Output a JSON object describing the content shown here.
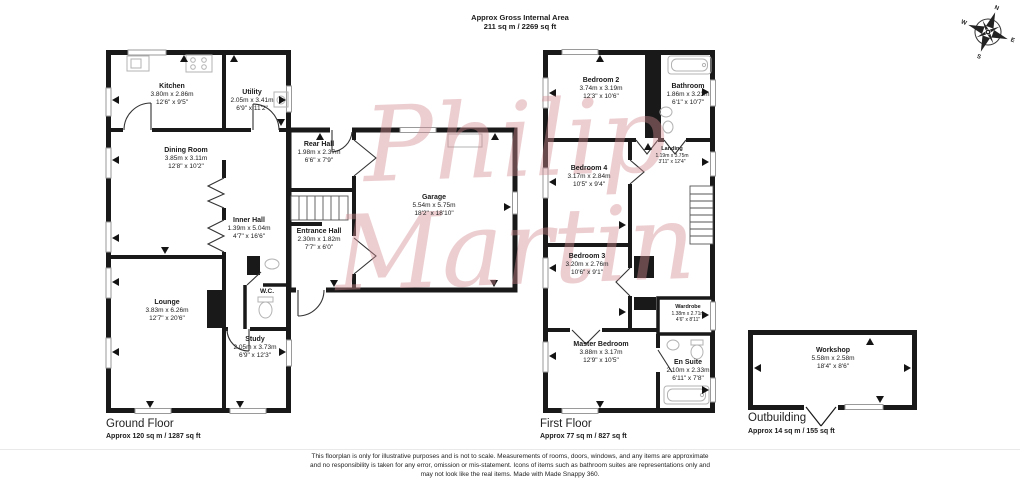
{
  "header": {
    "line1": "Approx Gross Internal Area",
    "line2": "211 sq m / 2269 sq ft"
  },
  "compass": {
    "north": "N",
    "east": "E",
    "south": "S",
    "west": "W"
  },
  "watermark": {
    "line1": "Philip",
    "line2": "Martin",
    "color": "#d28d94"
  },
  "ground_floor": {
    "title": "Ground Floor",
    "area": "Approx 120 sq m / 1287 sq ft",
    "rooms": [
      {
        "name": "Kitchen",
        "metric": "3.80m x 2.86m",
        "imperial": "12'6\" x 9'5\""
      },
      {
        "name": "Utility",
        "metric": "2.05m x 3.41m",
        "imperial": "6'9\" x 11'2\""
      },
      {
        "name": "Dining Room",
        "metric": "3.85m x 3.11m",
        "imperial": "12'8\" x 10'2\""
      },
      {
        "name": "Rear Hall",
        "metric": "1.98m x 2.37m",
        "imperial": "6'6\" x 7'9\""
      },
      {
        "name": "Inner Hall",
        "metric": "1.39m x 5.04m",
        "imperial": "4'7\" x 16'6\""
      },
      {
        "name": "Entrance Hall",
        "metric": "2.30m x 1.82m",
        "imperial": "7'7\" x 6'0\""
      },
      {
        "name": "Garage",
        "metric": "5.54m x 5.75m",
        "imperial": "18'2\" x 18'10\""
      },
      {
        "name": "Lounge",
        "metric": "3.83m x 6.26m",
        "imperial": "12'7\" x 20'6\""
      },
      {
        "name": "W.C.",
        "metric": "",
        "imperial": ""
      },
      {
        "name": "Study",
        "metric": "2.05m x 3.73m",
        "imperial": "6'9\" x 12'3\""
      }
    ]
  },
  "first_floor": {
    "title": "First Floor",
    "area": "Approx 77 sq m / 827 sq ft",
    "rooms": [
      {
        "name": "Bedroom 2",
        "metric": "3.74m x 3.19m",
        "imperial": "12'3\" x 10'6\""
      },
      {
        "name": "Bathroom",
        "metric": "1.86m x 3.23m",
        "imperial": "6'1\" x 10'7\""
      },
      {
        "name": "Landing",
        "metric": "1.19m x 3.75m",
        "imperial": "3'11\" x 12'4\""
      },
      {
        "name": "Bedroom 4",
        "metric": "3.17m x 2.84m",
        "imperial": "10'5\" x 9'4\""
      },
      {
        "name": "Bedroom 3",
        "metric": "3.20m x 2.76m",
        "imperial": "10'6\" x 9'1\""
      },
      {
        "name": "Wardrobe",
        "metric": "1.38m x 2.71m",
        "imperial": "4'6\" x 8'11\""
      },
      {
        "name": "Master Bedroom",
        "metric": "3.88m x 3.17m",
        "imperial": "12'9\" x 10'5\""
      },
      {
        "name": "En Suite",
        "metric": "2.10m x 2.33m",
        "imperial": "6'11\" x 7'8\""
      }
    ]
  },
  "outbuilding": {
    "title": "Outbuilding",
    "area": "Approx 14 sq m / 155 sq ft",
    "rooms": [
      {
        "name": "Workshop",
        "metric": "5.58m x 2.58m",
        "imperial": "18'4\" x 8'6\""
      }
    ]
  },
  "disclaimer": {
    "line1": "This floorplan is only for illustrative purposes and is not to scale. Measurements of rooms, doors, windows, and any items are approximate",
    "line2": "and no responsibility is taken for any error, omission or mis-statement. Icons of items such as bathroom suites are representations only and",
    "line3": "may not look like the real items. Made with Made Snappy 360."
  }
}
